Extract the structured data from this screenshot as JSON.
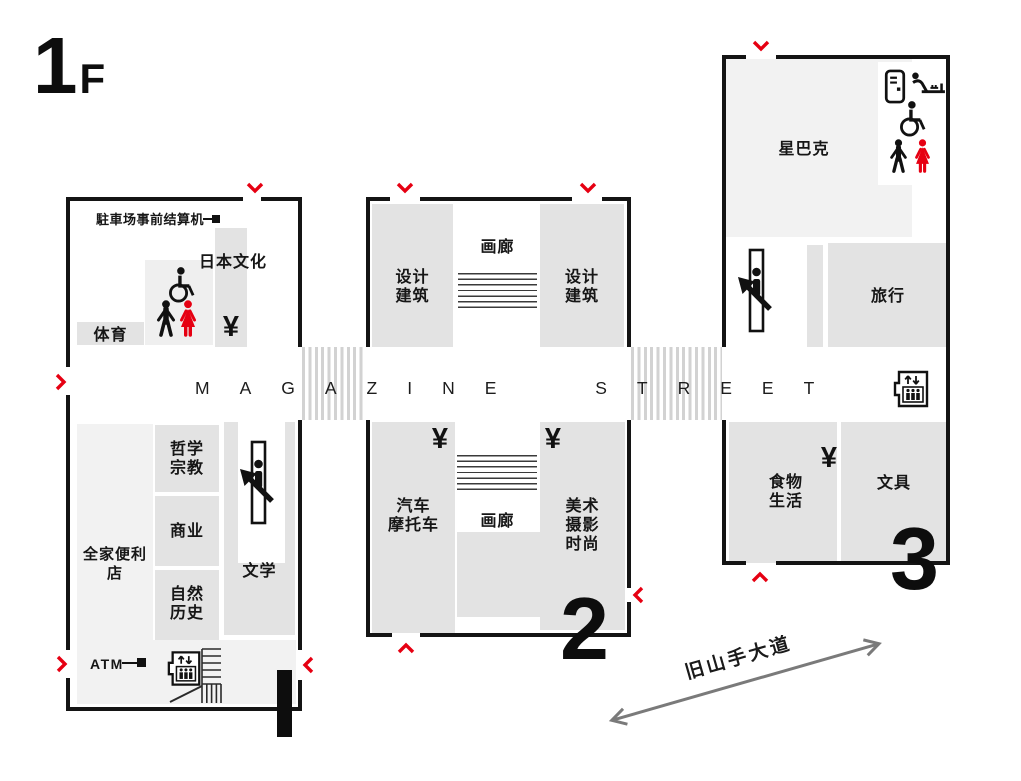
{
  "floor": {
    "big": "1",
    "small": "F"
  },
  "street": {
    "name": "MAGAZINE STREET"
  },
  "road": {
    "name": "旧山手大道"
  },
  "symbols": {
    "yen": "¥"
  },
  "colors": {
    "accent_red": "#e60012",
    "zone_gray": "#e3e3e3",
    "zone_light": "#f2f2f2",
    "wall_black": "#141414"
  },
  "icon_names": [
    "parking-pay-machine",
    "wheelchair",
    "men-restroom",
    "women-restroom",
    "escalator",
    "elevator",
    "stairs",
    "vending-machine",
    "baby-changing",
    "cash-register-yen",
    "entrance-chevron"
  ],
  "b1": {
    "number": "1",
    "parking_machine_label": "駐車场事前结算机",
    "atm_label": "ATM",
    "zones": {
      "japanese_culture": "日本文化",
      "sports": "体育",
      "philosophy_religion": "哲学\n宗教",
      "business": "商业",
      "nature_history": "自然\n历史",
      "literature": "文学",
      "familymart": "全家便利店"
    }
  },
  "b2": {
    "number": "2",
    "zones": {
      "design_architecture_left": "设计\n建筑",
      "design_architecture_right": "设计\n建筑",
      "gallery_upper": "画廊",
      "gallery_lower": "画廊",
      "cars_motorcycles": "汽车\n摩托车",
      "art_photo_fashion": "美术\n摄影\n时尚"
    }
  },
  "b3": {
    "number": "3",
    "zones": {
      "starbucks": "星巴克",
      "travel": "旅行",
      "food_life": "食物\n生活",
      "stationery": "文具"
    }
  }
}
